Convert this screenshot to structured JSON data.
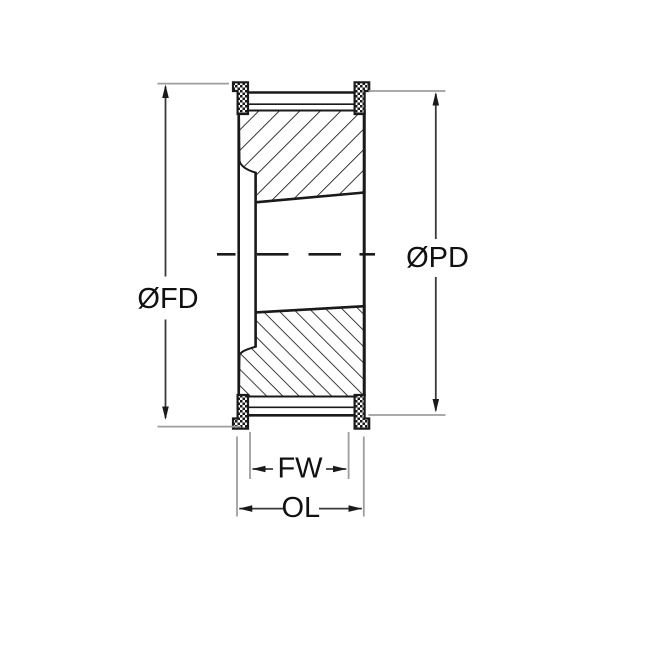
{
  "diagram": {
    "dimension_labels": {
      "flange_diameter": "ØFD",
      "pitch_diameter": "ØPD",
      "face_width": "FW",
      "overall_length": "OL"
    },
    "colors": {
      "drawing_line": "#1a1a1a",
      "dimension_line": "#3a3a3a",
      "extension_line": "#9e9e9e",
      "label_text": "#111111",
      "background": "#ffffff"
    }
  }
}
